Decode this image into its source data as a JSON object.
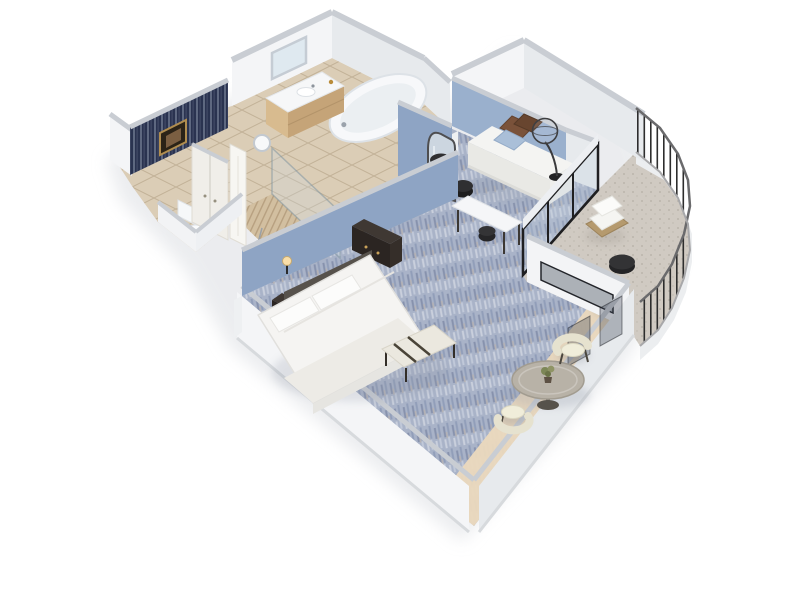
{
  "scene": {
    "name": "hotel-suite-3d-floor-plan",
    "style": "isometric dollhouse cutaway render on white background",
    "background": "#ffffff"
  },
  "colors": {
    "wall_face": "#f4f5f7",
    "wall_face_shaded": "#e7eaed",
    "wall_top": "#c9cdd3",
    "accent_blue": "#8ea4c4",
    "accent_blue_light": "#9ab0cd",
    "navy_accent": "#2a3350",
    "carpet": "#a9b3c8",
    "tile": "#dbcdb6",
    "shower_tile": "#d2bfa0",
    "wood_floor": "#ead9bd",
    "balcony_floor": "#d0cac2",
    "railing": "#2d2d2d",
    "bedding": "#f5f4f2",
    "pillow_brown": "#7a523a",
    "pillow_blue": "#aabfd8",
    "furniture_dark": "#2b2522",
    "chair_cream": "#e9e5d2",
    "table_top": "#b8b2a7",
    "wicker": "#b59a6e",
    "glass": "rgba(190,205,220,0.28)",
    "gold_frame": "#b08d4f"
  },
  "rooms": [
    {
      "id": "entry-hall",
      "label": "Entry hall with navy striped accent wall and framed art"
    },
    {
      "id": "closet",
      "label": "Closet with double doors"
    },
    {
      "id": "bathroom",
      "label": "Bathroom with vanity, mirror and bathtub"
    },
    {
      "id": "water-closet",
      "label": "Toilet room"
    },
    {
      "id": "shower",
      "label": "Glass shower with tan tile"
    },
    {
      "id": "bedroom",
      "label": "Bedroom with king bed on blue accent wall"
    },
    {
      "id": "sitting-alcove",
      "label": "Sitting alcove with daybed sofa"
    },
    {
      "id": "dining-nook",
      "label": "Dining nook with round table"
    },
    {
      "id": "balcony",
      "label": "Curved balcony with metal railing"
    }
  ],
  "furniture": {
    "bedroom": [
      "bed",
      "pillows",
      "headboard",
      "nightstand",
      "tv-dresser",
      "wall-sconces",
      "foot-bench"
    ],
    "sitting_alcove": [
      "daybed-sofa",
      "throw-pillows",
      "arc-floor-lamp",
      "arch-floor-mirror",
      "black-stools",
      "desk"
    ],
    "bathroom": [
      "vanity",
      "sink",
      "mirror",
      "bathtub",
      "toilet",
      "shower-wand",
      "ceiling-light"
    ],
    "dining_nook": [
      "round-pedestal-table",
      "potted-plant",
      "barrel-chair",
      "barrel-chair"
    ],
    "balcony": [
      "wicker-lounge-chair",
      "wicker-lounge-chair",
      "black-side-table",
      "white-planter"
    ]
  }
}
